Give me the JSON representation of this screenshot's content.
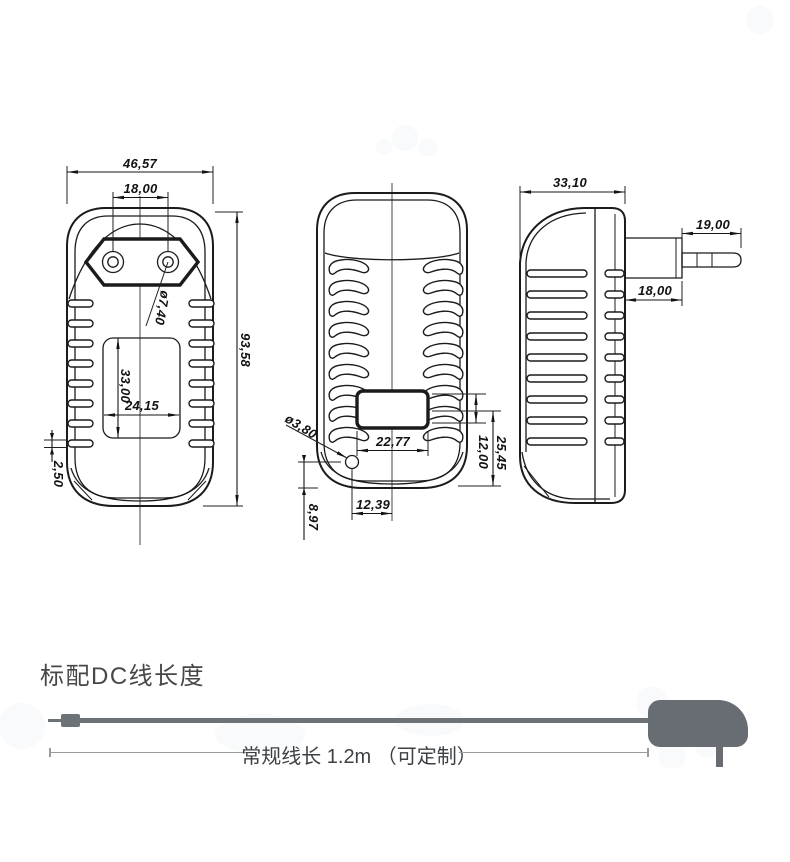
{
  "views": {
    "front": {
      "overall_width": "46,57",
      "pin_spacing": "18,00",
      "pin_hole_diameter": "ø7,40",
      "overall_height": "93,58",
      "label_area_height": "33,00",
      "label_area_width": "24,15",
      "bottom_rib_height": "2,50"
    },
    "back": {
      "hole_diameter": "ø3,80",
      "recess_width": "22,77",
      "recess_height": "12,00",
      "recess_to_bottom": "25,45",
      "hole_offset_horizontal": "12,39",
      "hole_offset_vertical": "8,97"
    },
    "side": {
      "body_depth": "33,10",
      "pin_length": "19,00",
      "plug_base_depth": "18,00"
    }
  },
  "cable_section": {
    "title": "标配DC线长度",
    "length_label": "常规线长 1.2m （可定制）"
  },
  "colors": {
    "line": "#1b1b1b",
    "figure_gray": "#686d73",
    "dim_gray": "#9b9b9b",
    "text_dark": "#474747"
  }
}
